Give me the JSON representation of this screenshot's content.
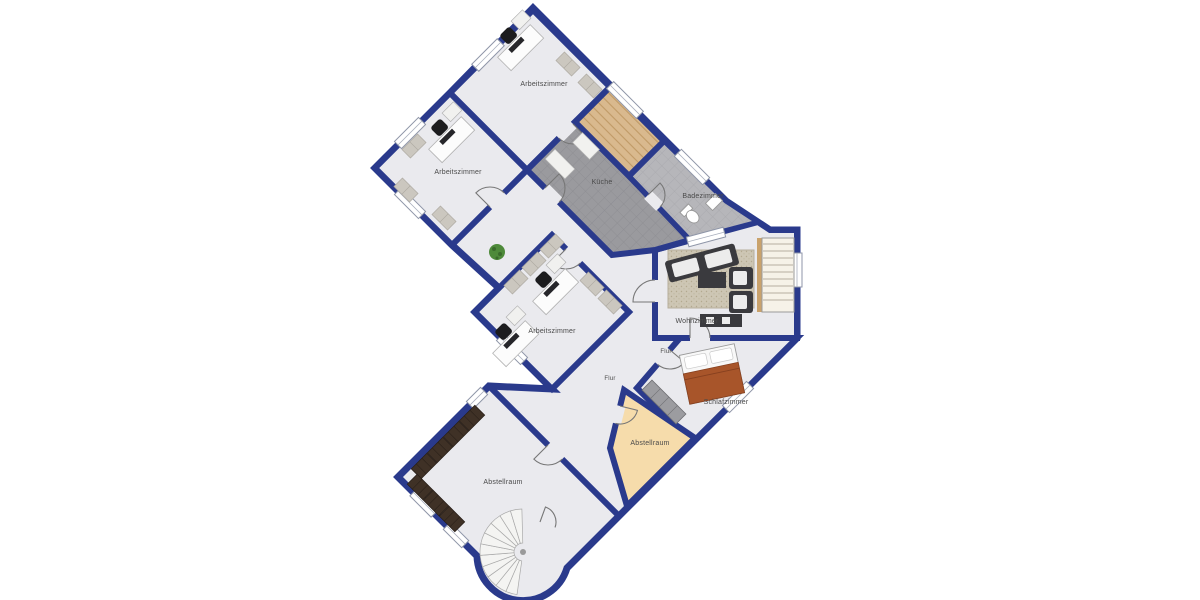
{
  "plan": {
    "type": "apartment-floor-plan",
    "language": "de"
  },
  "rooms": {
    "arbeitszimmer_oben": {
      "label": "Arbeitszimmer"
    },
    "arbeitszimmer_links": {
      "label": "Arbeitszimmer"
    },
    "arbeitszimmer_mitte": {
      "label": "Arbeitszimmer"
    },
    "kueche": {
      "label": "Küche"
    },
    "badezimmer": {
      "label": "Badezimmer"
    },
    "wohnzimmer": {
      "label": "Wohnzimmer"
    },
    "flur_oben": {
      "label": "Flur"
    },
    "flur_unten": {
      "label": "Flur"
    },
    "schlafzimmer": {
      "label": "Schlafzimmer"
    },
    "abstellraum_klein": {
      "label": "Abstellraum"
    },
    "abstellraum_gross": {
      "label": "Abstellraum"
    }
  },
  "colors": {
    "wall": "#2a3a8c",
    "floor": "#eaeaee",
    "tile_dark": "#9a9a9e",
    "tile_dark_line": "#8b8b90",
    "tile_light": "#b6b6ba",
    "tile_light_line": "#a7a7ac",
    "wood": "#d9b98e",
    "wood_line": "#c09a66",
    "peach": "#f6dcab",
    "bed_blanket": "#a8552a",
    "plant": "#4e8a3a",
    "rug": "#cdc6b4",
    "furniture_dark": "#3a3a3e",
    "cabinet": "#3f3126",
    "shelf": "#cbc7bf",
    "stair": "#f6f2e8",
    "background": "#ffffff"
  },
  "icons": [
    "desk-icon",
    "office-chair-icon",
    "shelf-icon",
    "cabinet-icon",
    "plant-icon",
    "sofa-icon",
    "armchair-icon",
    "coffee-table-icon",
    "tv-bench-icon",
    "rug-icon",
    "bed-icon",
    "wardrobe-icon",
    "toilet-icon",
    "sink-icon",
    "staircase-icon",
    "spiral-staircase-icon",
    "door-icon",
    "window-icon"
  ]
}
